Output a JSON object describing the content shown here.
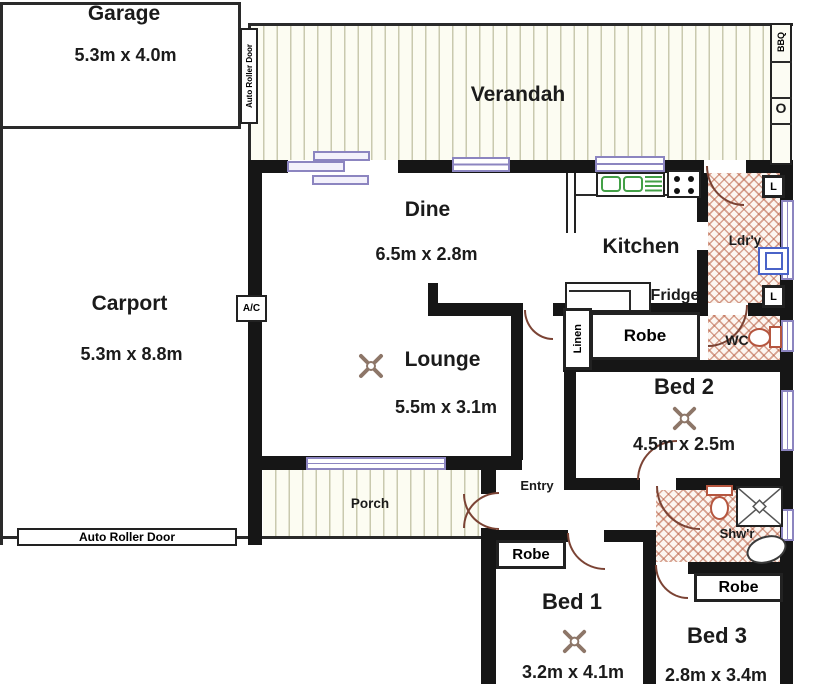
{
  "rooms": {
    "garage": {
      "name": "Garage",
      "dims": "5.3m x 4.0m"
    },
    "carport": {
      "name": "Carport",
      "dims": "5.3m x 8.8m"
    },
    "verandah": {
      "name": "Verandah"
    },
    "porch": {
      "name": "Porch"
    },
    "dine": {
      "name": "Dine",
      "dims": "6.5m x 2.8m"
    },
    "kitchen": {
      "name": "Kitchen"
    },
    "laundry": {
      "name": "Ldr'y"
    },
    "lounge": {
      "name": "Lounge",
      "dims": "5.5m x 3.1m"
    },
    "bed1": {
      "name": "Bed 1",
      "dims": "3.2m x 4.1m"
    },
    "bed2": {
      "name": "Bed 2",
      "dims": "4.5m x 2.5m"
    },
    "bed3": {
      "name": "Bed 3",
      "dims": "2.8m x 3.4m"
    },
    "wc": {
      "name": "WC"
    },
    "shower": {
      "name": "Shw'r"
    },
    "entry": {
      "name": "Entry"
    }
  },
  "labels": {
    "auto_roller_door_garage": "Auto Roller Door",
    "auto_roller_door_carport": "Auto Roller Door",
    "robe_bed1": "Robe",
    "robe_bed2": "Robe",
    "robe_bed3": "Robe",
    "fridge": "Fridge",
    "linen_tall": "Linen",
    "linen_cupboard_top": "L",
    "linen_cupboard_bottom": "L",
    "ac_unit": "A/C",
    "bbq": "BBQ",
    "bbq_sink": "O"
  },
  "colors": {
    "wall": "#161616",
    "door_arc": "#7b4334",
    "window": "#8c85c0",
    "deck_stripe": "#c9c9ae",
    "tile_hatch": "#b85c40",
    "sink": "#43a047",
    "laundry_tub": "#4a63c8",
    "toilet": "#b5563f"
  }
}
